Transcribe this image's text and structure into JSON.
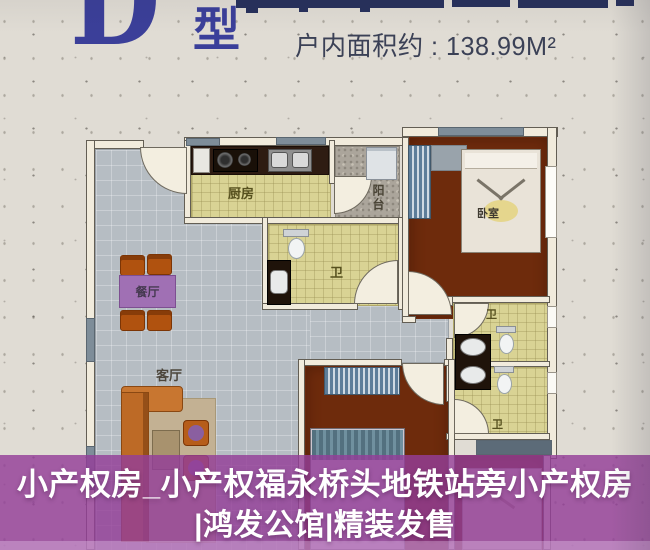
{
  "header": {
    "unit_letter": "D",
    "unit_suffix": "型",
    "area_text": "户内面积约 : 138.99M²"
  },
  "floorplan": {
    "room_labels": {
      "kitchen": "厨房",
      "balcony": "阳台",
      "dining": "餐厅",
      "living": "客厅",
      "bedroom": "卧室",
      "bathroom": "卫"
    }
  },
  "caption": {
    "line1": "小产权房_小产权福永桥头地铁站旁小产权房",
    "line2": "|鸿发公馆|精装发售"
  },
  "colors": {
    "headline_blue": "#3b3f9a",
    "banner_navy": "#27305c",
    "paper_background": "#e0dcd4",
    "floor_gray": "#b6bdc3",
    "floor_yellow": "#d9d394",
    "floor_brown": "#6e2b0c",
    "wall_cream": "#f1ebdc",
    "window_gray": "#7e8d99",
    "overlay_purple": "#94459a",
    "caption_text": "#ffffff"
  }
}
